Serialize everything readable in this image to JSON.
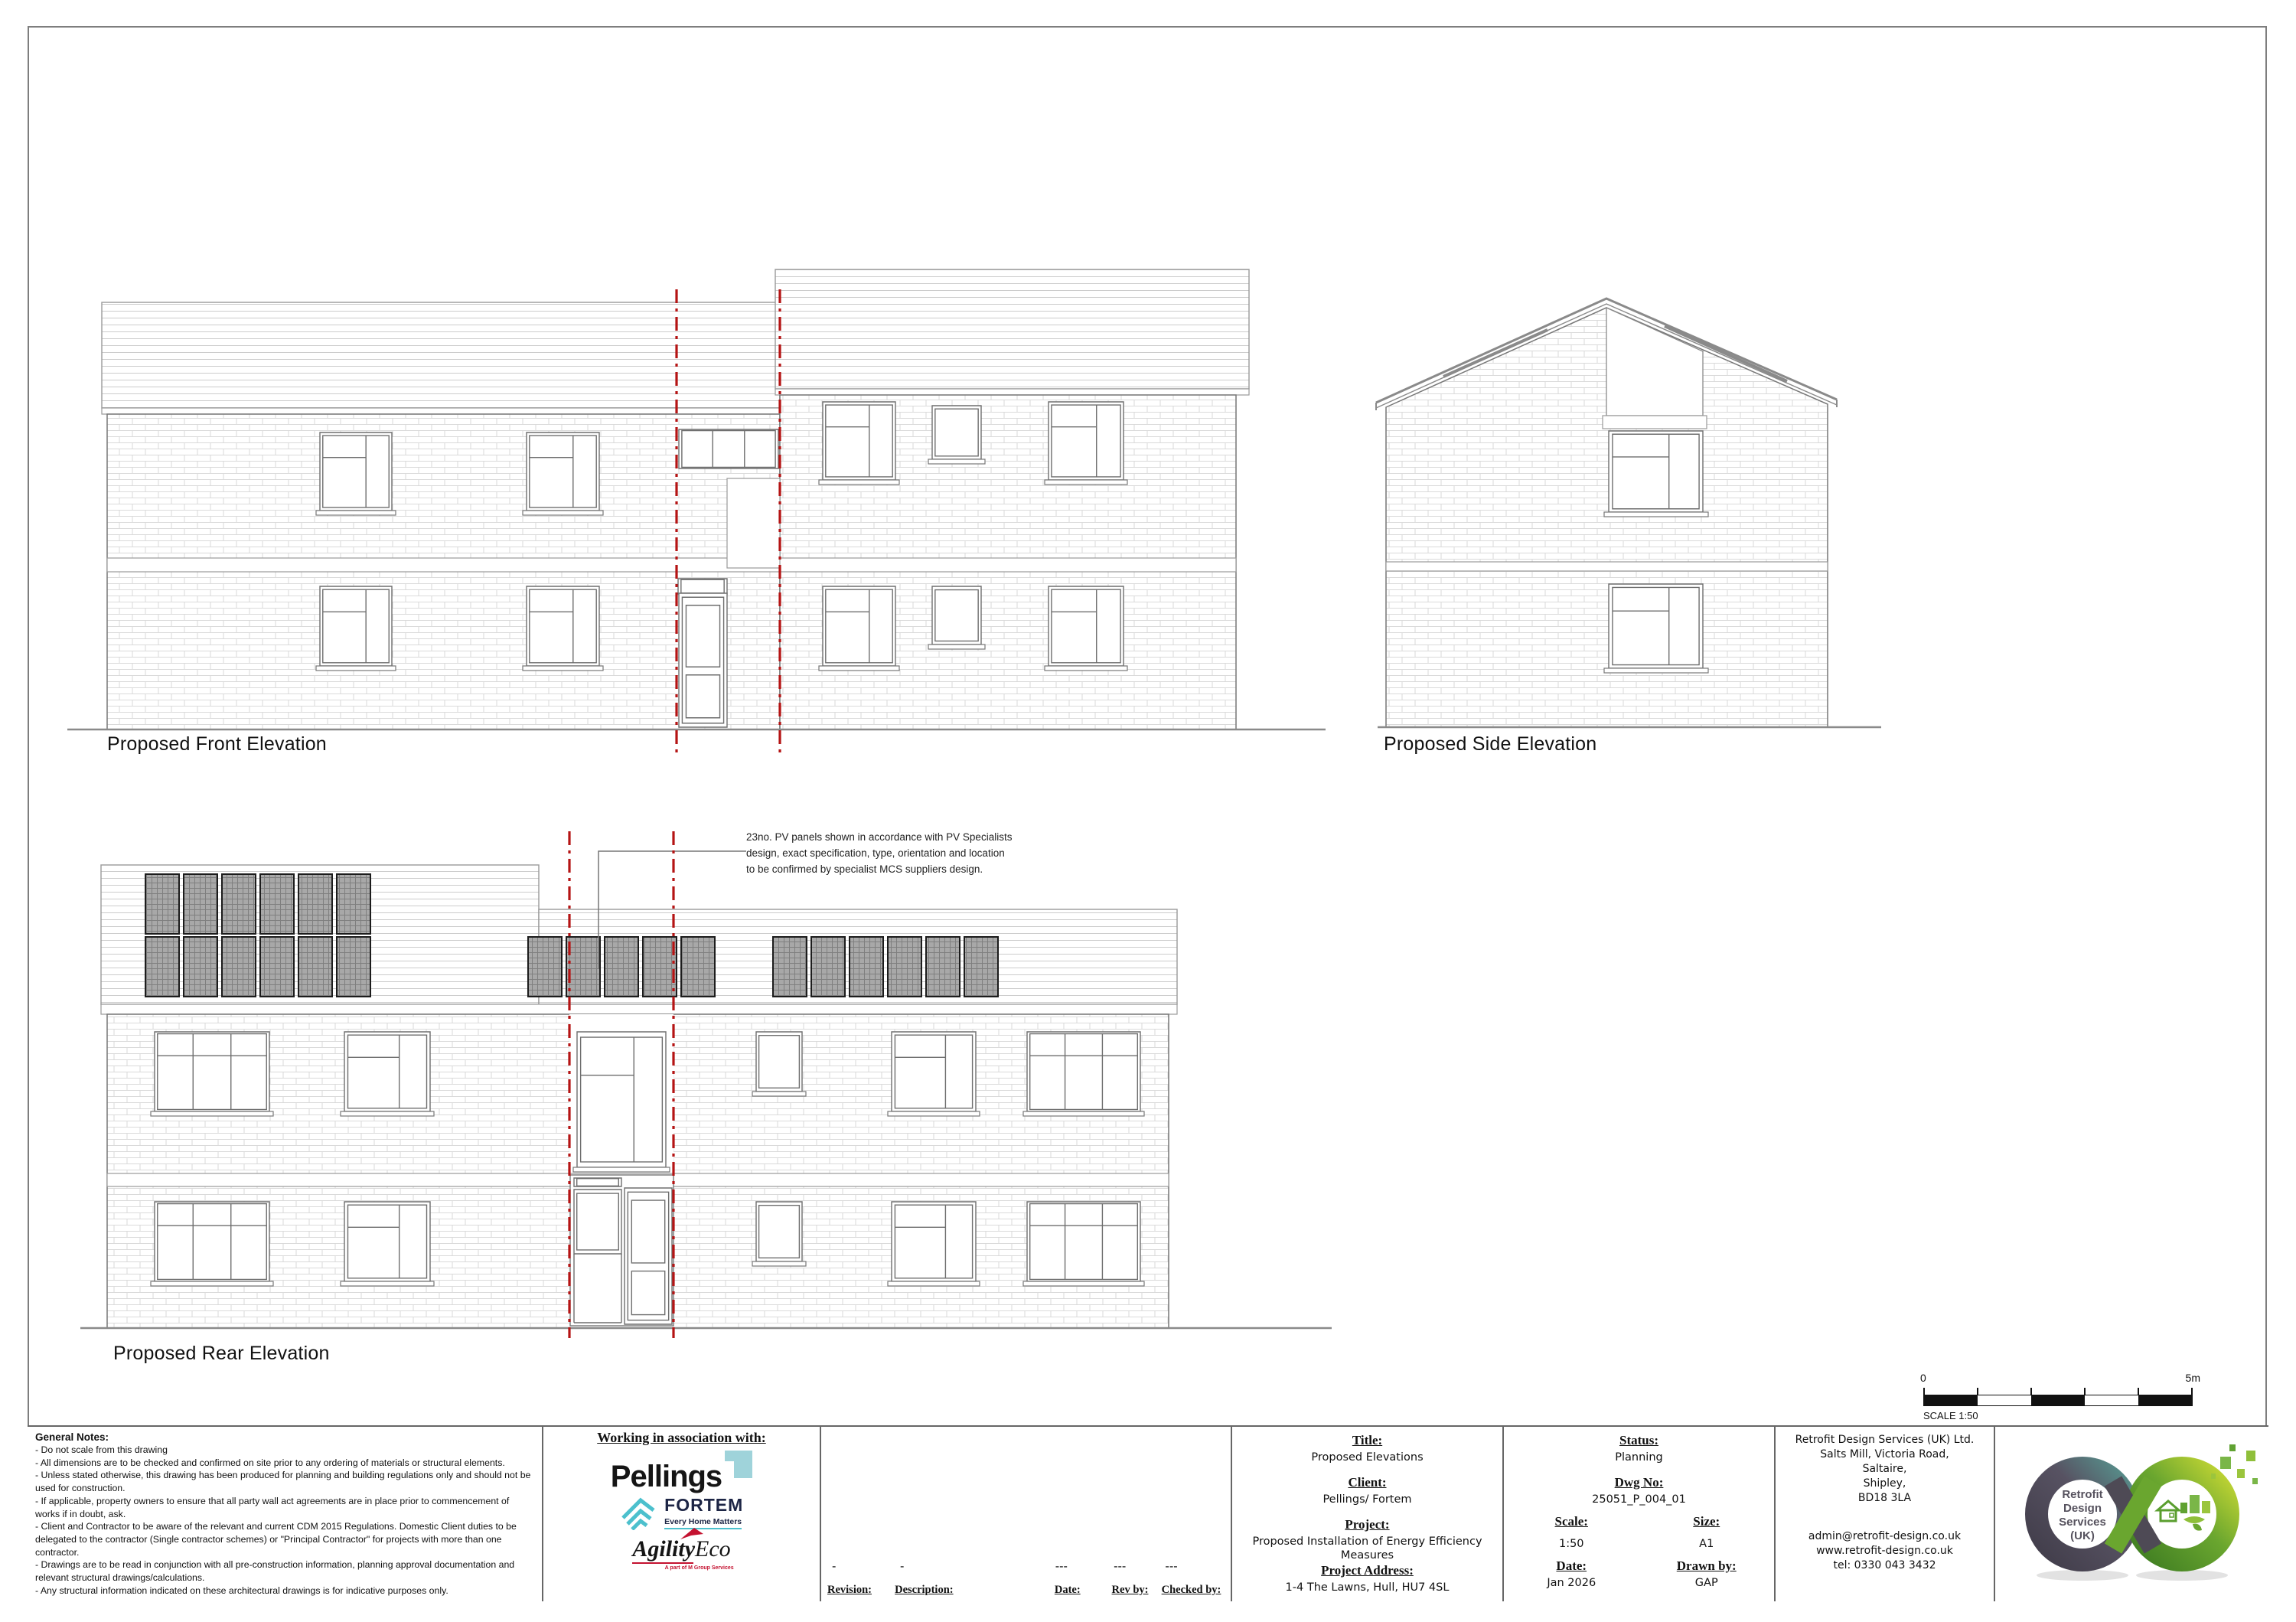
{
  "elevations": {
    "front_label": "Proposed Front Elevation",
    "side_label": "Proposed Side Elevation",
    "rear_label": "Proposed Rear Elevation",
    "pv_annotation_line1": "23no. PV panels shown in accordance with PV Specialists",
    "pv_annotation_line2": "design, exact specification, type, orientation and location",
    "pv_annotation_line3": "to be confirmed by specialist MCS suppliers design."
  },
  "scale_bar": {
    "zero_label": "0",
    "max_label": "5m",
    "caption": "SCALE 1:50"
  },
  "title_block": {
    "general_notes": {
      "heading": "General Notes:",
      "notes": [
        "- Do not scale from this drawing",
        "- All dimensions are to be checked and confirmed on site prior to any ordering of materials or structural elements.",
        "- Unless stated otherwise, this drawing has been produced for planning and building regulations only and should not be used for construction.",
        "- If applicable, property owners to ensure that all party wall act agreements are in place prior to commencement of works if in doubt, ask.",
        "- Client and Contractor to be aware of the relevant and current CDM 2015 Regulations. Domestic Client duties to be delegated to the contractor (Single contractor schemes) or \"Principal Contractor\" for projects with more than one contractor.",
        "- Drawings are to be read in conjunction with all pre-construction information, planning approval documentation and relevant structural drawings/calculations.",
        "- Any structural information indicated on these architectural drawings is for indicative purposes only."
      ]
    },
    "association": {
      "heading": "Working in association with:",
      "pellings": "Pellings",
      "fortem": "FORTEM",
      "fortem_tagline": "Every Home Matters",
      "agility_bold": "Agility",
      "agility_light": "Eco",
      "agility_tagline": "A part of M Group Services"
    },
    "revision_row": {
      "revision_value": "-",
      "description_value": "-",
      "date_value": "---",
      "rev_by_value": "---",
      "checked_by_value": "---",
      "revision_label": "Revision:",
      "description_label": "Description:",
      "date_label": "Date:",
      "rev_by_label": "Rev by:",
      "checked_by_label": "Checked by:"
    },
    "project_info": {
      "title_label": "Title:",
      "title_value": "Proposed Elevations",
      "client_label": "Client:",
      "client_value": "Pellings/ Fortem",
      "project_label": "Project:",
      "project_value": "Proposed Installation of Energy Efficiency Measures",
      "address_label": "Project Address:",
      "address_value": "1-4 The Lawns, Hull, HU7 4SL"
    },
    "drawing_info": {
      "status_label": "Status:",
      "status_value": "Planning",
      "dwg_no_label": "Dwg No:",
      "dwg_no_value": "25051_P_004_01",
      "scale_label": "Scale:",
      "scale_value": "1:50",
      "size_label": "Size:",
      "size_value": "A1",
      "date_label": "Date:",
      "date_value": "Jan 2026",
      "drawn_by_label": "Drawn by:",
      "drawn_by_value": "GAP"
    },
    "company": {
      "address_lines": [
        "Retrofit Design Services (UK) Ltd.",
        "Salts Mill, Victoria Road,",
        "Saltaire,",
        "Shipley,",
        "BD18 3LA"
      ],
      "contact_lines": [
        "admin@retrofit-design.co.uk",
        "www.retrofit-design.co.uk",
        "tel:   0330 043 3432"
      ],
      "logo_text_lines": [
        "Retrofit",
        "Design",
        "Services",
        "(UK)"
      ]
    }
  },
  "colors": {
    "centerline_red": "#b51414",
    "pellings_teal": "#9fd3da",
    "fortem_teal": "#4cc0cd",
    "fortem_navy": "#1d2545",
    "agility_red": "#c41230",
    "rds_green": "#6aa62f",
    "rds_dark": "#4e4a55"
  }
}
